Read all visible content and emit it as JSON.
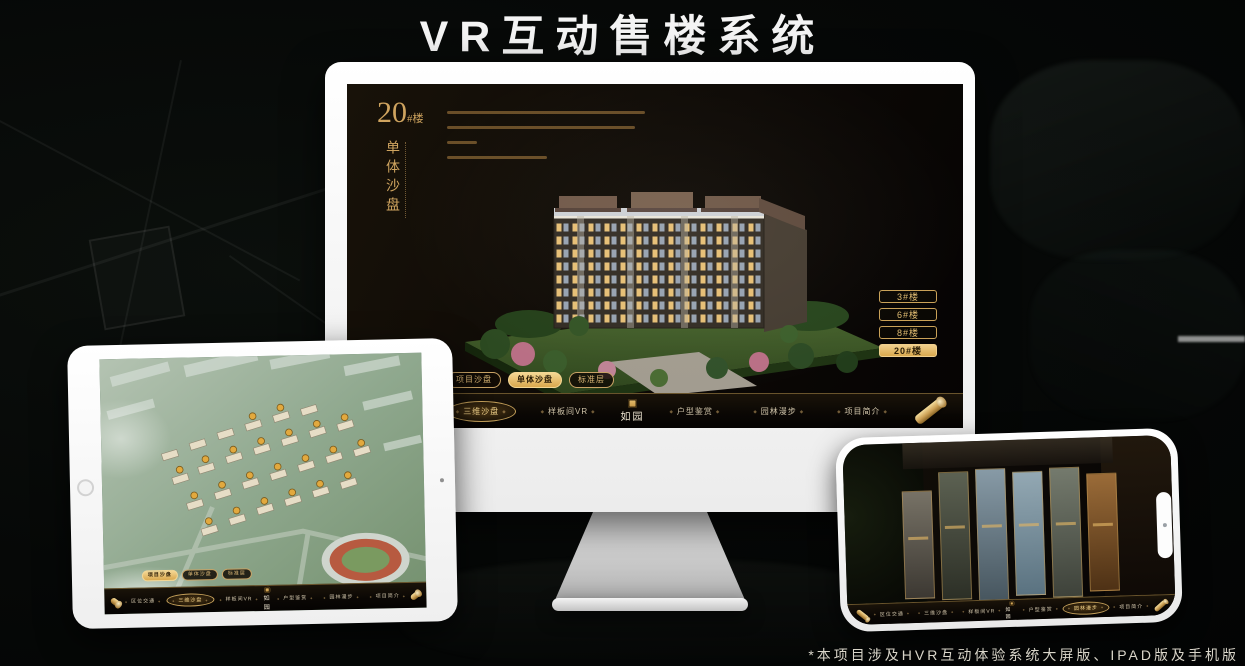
{
  "header": {
    "title": "VR互动售楼系统"
  },
  "footer": {
    "note": "*本项目涉及HVR互动体验系统大屏版、IPAD版及手机版"
  },
  "brand": {
    "logo_text": "如园"
  },
  "colors": {
    "gold": "#c9a365",
    "gold_bright": "#f0cf8d",
    "screen_dark": "#0e0a06"
  },
  "monitor_app": {
    "block_number": "20",
    "block_unit": "#楼",
    "block_subtitle": "单体沙盘",
    "floor_buttons": [
      {
        "label": "3#楼",
        "active": false
      },
      {
        "label": "6#楼",
        "active": false
      },
      {
        "label": "8#楼",
        "active": false
      },
      {
        "label": "20#楼",
        "active": true
      }
    ],
    "sub_tabs": [
      {
        "label": "项目沙盘",
        "active": false
      },
      {
        "label": "单体沙盘",
        "active": true
      },
      {
        "label": "标准层",
        "active": false
      }
    ],
    "nav_items": [
      {
        "label": "区位交通",
        "active": false
      },
      {
        "label": "三维沙盘",
        "active": true
      },
      {
        "label": "样板间VR",
        "active": false
      },
      {
        "label": "户型鉴赏",
        "active": false
      },
      {
        "label": "园林漫步",
        "active": false
      },
      {
        "label": "项目简介",
        "active": false
      }
    ]
  },
  "ipad_app": {
    "sub_tabs": [
      {
        "label": "项目沙盘",
        "active": true
      },
      {
        "label": "单体沙盘",
        "active": false
      },
      {
        "label": "标准层",
        "active": false
      }
    ],
    "nav_items": [
      {
        "label": "区位交通",
        "active": false
      },
      {
        "label": "三维沙盘",
        "active": true
      },
      {
        "label": "样板间VR",
        "active": false
      },
      {
        "label": "户型鉴赏",
        "active": false
      },
      {
        "label": "园林漫步",
        "active": false
      },
      {
        "label": "项目简介",
        "active": false
      }
    ]
  },
  "phone_app": {
    "nav_items": [
      {
        "label": "区位交通",
        "active": false
      },
      {
        "label": "三维沙盘",
        "active": false
      },
      {
        "label": "样板间VR",
        "active": false
      },
      {
        "label": "户型鉴赏",
        "active": false
      },
      {
        "label": "园林漫步",
        "active": true
      },
      {
        "label": "项目简介",
        "active": false
      }
    ]
  }
}
